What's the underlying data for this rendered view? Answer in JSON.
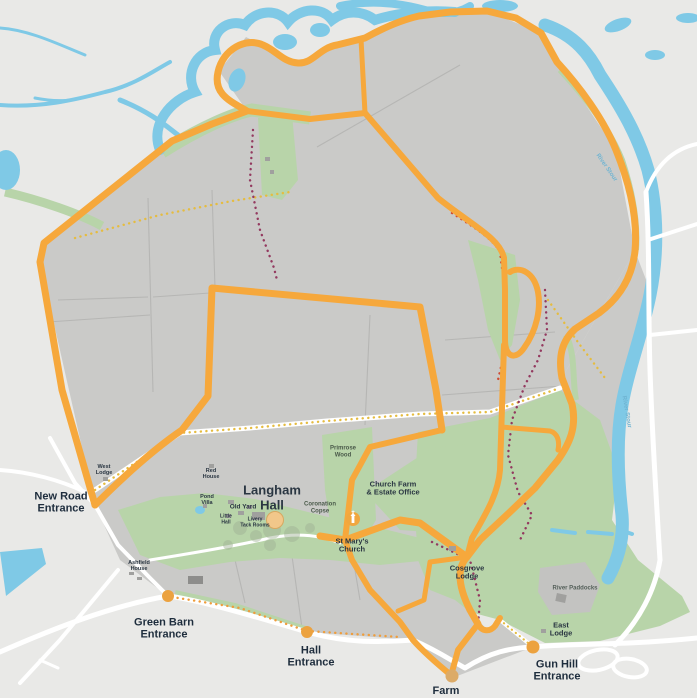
{
  "map": {
    "colors": {
      "background": "#e9e9e7",
      "estate_field_gray": "#cacac8",
      "field_boundary": "#b6b6b4",
      "woodland_green": "#b8d4a9",
      "water_blue": "#7fc9e6",
      "road_white": "#ffffff",
      "main_route_orange": "#f6a83c",
      "entrance_marker_orange": "#eca23f",
      "red_dotted_path": "#cf4a33",
      "purple_dotted_path": "#93395f",
      "yellow_dotted_path": "#e5bc40",
      "orange_dotted_path": "#ef9d3c",
      "label_navy": "#1e2d3d"
    },
    "routes": [
      {
        "id": "main-walk-route",
        "color": "#f6a83c",
        "style": "solid"
      },
      {
        "id": "red-dotted-path",
        "color": "#cf4a33",
        "style": "dotted"
      },
      {
        "id": "purple-dotted-path",
        "color": "#93395f",
        "style": "dotted"
      },
      {
        "id": "yellow-dotted-path",
        "color": "#e5bc40",
        "style": "dotted"
      },
      {
        "id": "orange-dotted-path",
        "color": "#ef9d3c",
        "style": "dotted"
      }
    ],
    "entrances": [
      {
        "id": "new-road-entrance",
        "lines": [
          "New Road",
          "Entrance"
        ],
        "x": 61,
        "y": 503,
        "size": 11
      },
      {
        "id": "green-barn-entrance",
        "lines": [
          "Green Barn",
          "Entrance"
        ],
        "x": 164,
        "y": 629,
        "size": 11
      },
      {
        "id": "hall-entrance",
        "lines": [
          "Hall",
          "Entrance"
        ],
        "x": 311,
        "y": 657,
        "size": 11
      },
      {
        "id": "farm-entrance",
        "lines": [
          "Farm"
        ],
        "x": 446,
        "y": 691,
        "size": 11
      },
      {
        "id": "gun-hill-entrance",
        "lines": [
          "Gun Hill",
          "Entrance"
        ],
        "x": 557,
        "y": 671,
        "size": 11
      }
    ],
    "places": [
      {
        "id": "langham-hall",
        "lines": [
          "Langham",
          "Hall"
        ],
        "x": 272,
        "y": 498,
        "size": 13,
        "weight": 800
      },
      {
        "id": "old-yard",
        "lines": [
          "Old Yard"
        ],
        "x": 243,
        "y": 507,
        "size": 6.5,
        "weight": 700
      },
      {
        "id": "west-lodge",
        "lines": [
          "West",
          "Lodge"
        ],
        "x": 104,
        "y": 470,
        "size": 5.5,
        "weight": 600
      },
      {
        "id": "red-house",
        "lines": [
          "Red",
          "House"
        ],
        "x": 211,
        "y": 474,
        "size": 5.5,
        "weight": 600
      },
      {
        "id": "pond-villa",
        "lines": [
          "Pond",
          "Villa"
        ],
        "x": 207,
        "y": 500,
        "size": 5.5,
        "weight": 600
      },
      {
        "id": "little-hall",
        "lines": [
          "Little",
          "Hall"
        ],
        "x": 226,
        "y": 520,
        "size": 5,
        "weight": 600
      },
      {
        "id": "livery-tack-rooms",
        "lines": [
          "Livery",
          "Tack Rooms"
        ],
        "x": 255,
        "y": 523,
        "size": 5,
        "weight": 600
      },
      {
        "id": "ashfield-house",
        "lines": [
          "Ashfield",
          "House"
        ],
        "x": 139,
        "y": 566,
        "size": 5.5,
        "weight": 600
      },
      {
        "id": "primrose-wood",
        "lines": [
          "Primrose",
          "Wood"
        ],
        "x": 343,
        "y": 452,
        "size": 6,
        "weight": 700,
        "color": "#4a5a4a"
      },
      {
        "id": "coronation-copse",
        "lines": [
          "Coronation",
          "Copse"
        ],
        "x": 320,
        "y": 508,
        "size": 6,
        "weight": 600,
        "color": "#4a5a4a"
      },
      {
        "id": "church-farm-estate-office",
        "lines": [
          "Church Farm",
          "& Estate Office"
        ],
        "x": 393,
        "y": 489,
        "size": 7.5,
        "weight": 800
      },
      {
        "id": "st-marys-church",
        "lines": [
          "St Mary's",
          "Church"
        ],
        "x": 352,
        "y": 546,
        "size": 7.5,
        "weight": 800
      },
      {
        "id": "cosgrove-lodge",
        "lines": [
          "Cosgrove",
          "Lodge"
        ],
        "x": 467,
        "y": 573,
        "size": 7.5,
        "weight": 800
      },
      {
        "id": "east-lodge",
        "lines": [
          "East",
          "Lodge"
        ],
        "x": 561,
        "y": 630,
        "size": 7.5,
        "weight": 800
      },
      {
        "id": "river-paddocks",
        "lines": [
          "River Paddocks"
        ],
        "x": 575,
        "y": 589,
        "size": 6,
        "weight": 600,
        "color": "#55605a"
      }
    ],
    "water_labels": [
      {
        "id": "river-stour-upper",
        "text": "River Stour",
        "x": 606,
        "y": 168,
        "size": 6,
        "rot": 55,
        "color": "#6fb4d2"
      },
      {
        "id": "river-stour-lower",
        "text": "River Stour",
        "x": 626,
        "y": 412,
        "size": 6,
        "rot": 80,
        "color": "#6fb4d2"
      }
    ],
    "markers": [
      {
        "id": "green-barn-entrance-marker",
        "x": 168,
        "y": 596,
        "r": 6
      },
      {
        "id": "hall-entrance-marker",
        "x": 307,
        "y": 632,
        "r": 6
      },
      {
        "id": "farm-entrance-marker",
        "x": 452,
        "y": 676,
        "r": 6.5
      },
      {
        "id": "gun-hill-entrance-marker",
        "x": 533,
        "y": 647,
        "r": 6.5
      },
      {
        "id": "st-marys-church-marker",
        "x": 353,
        "y": 519,
        "r": 7,
        "icon": "church-icon"
      },
      {
        "id": "langham-hall-marker",
        "x": 275,
        "y": 520,
        "r": 8.5,
        "icon": "hall-icon"
      }
    ]
  }
}
